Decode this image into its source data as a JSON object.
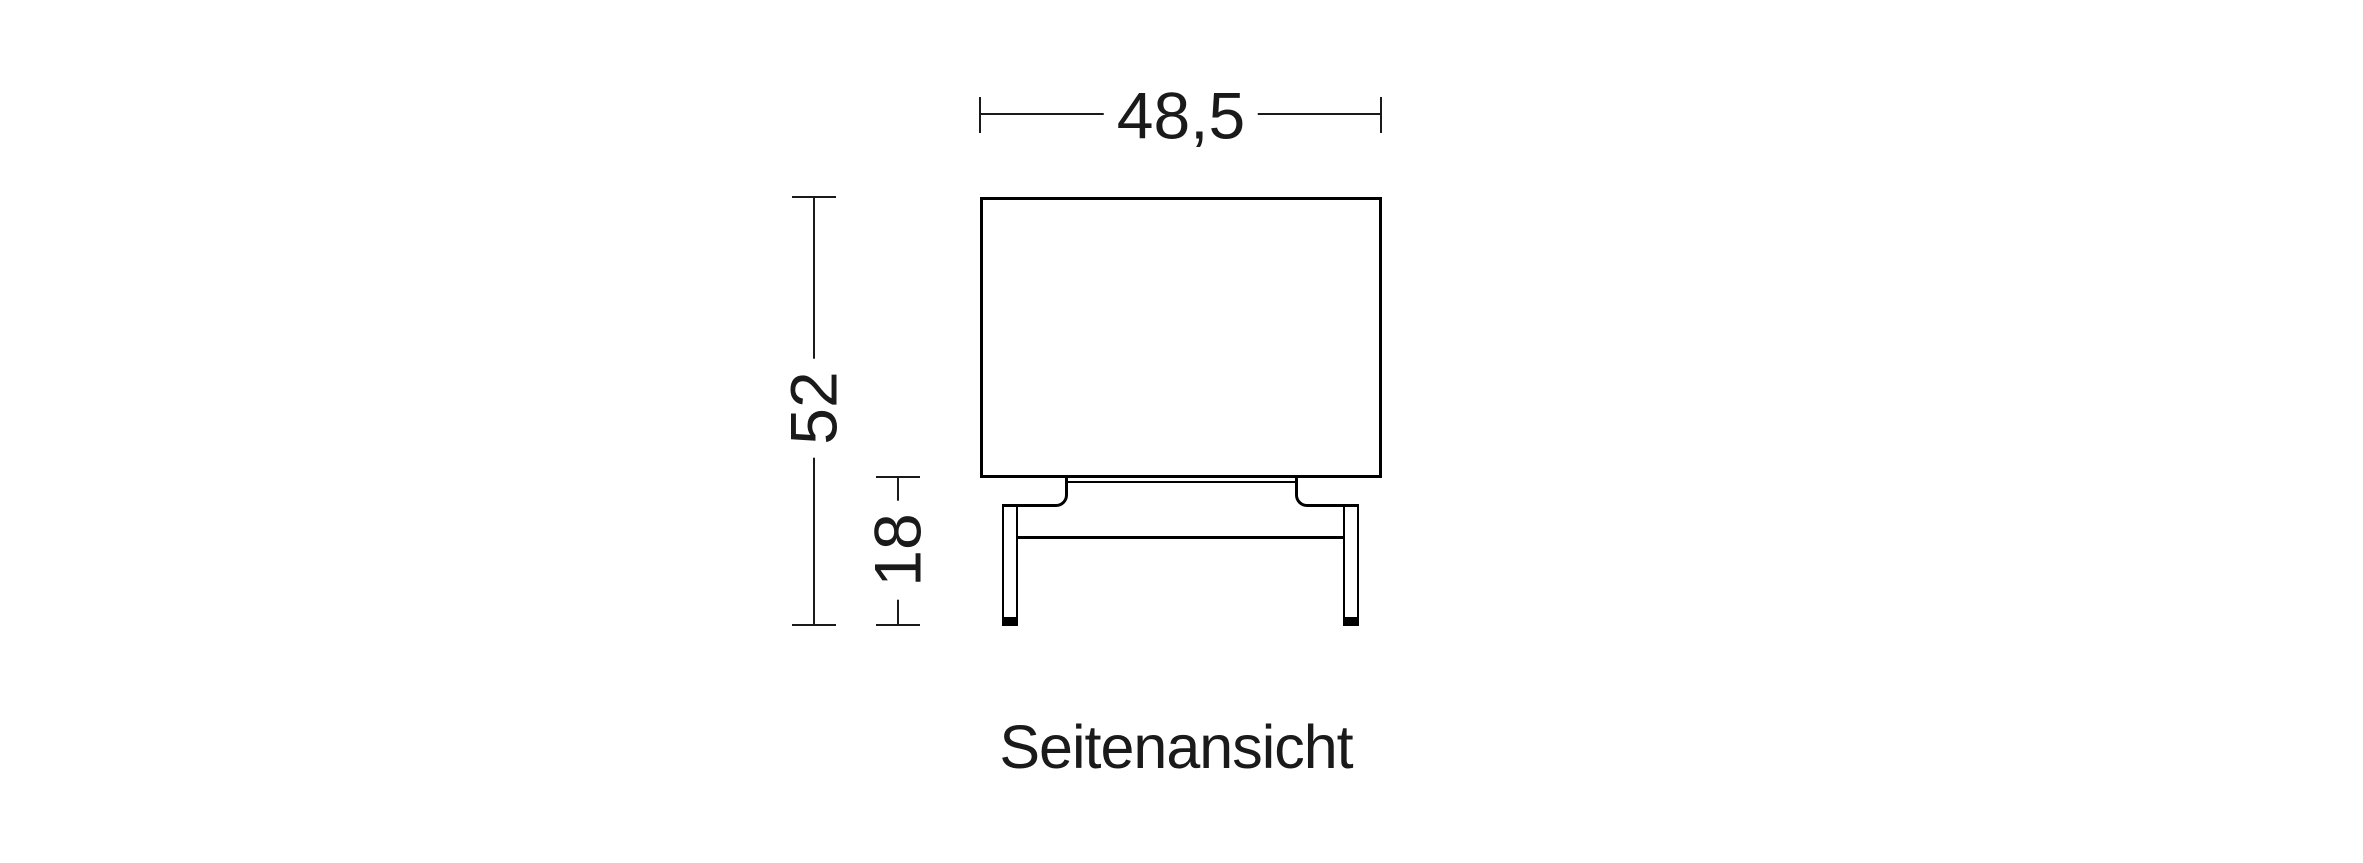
{
  "drawing": {
    "view_label": "Seitenansicht",
    "dimensions": {
      "width": "48,5",
      "total_height": "52",
      "leg_height": "18"
    }
  },
  "colors": {
    "background": "#ffffff",
    "outline": "#000000",
    "dimension_line": "#1a1a1a",
    "text": "#1a1a1a"
  }
}
